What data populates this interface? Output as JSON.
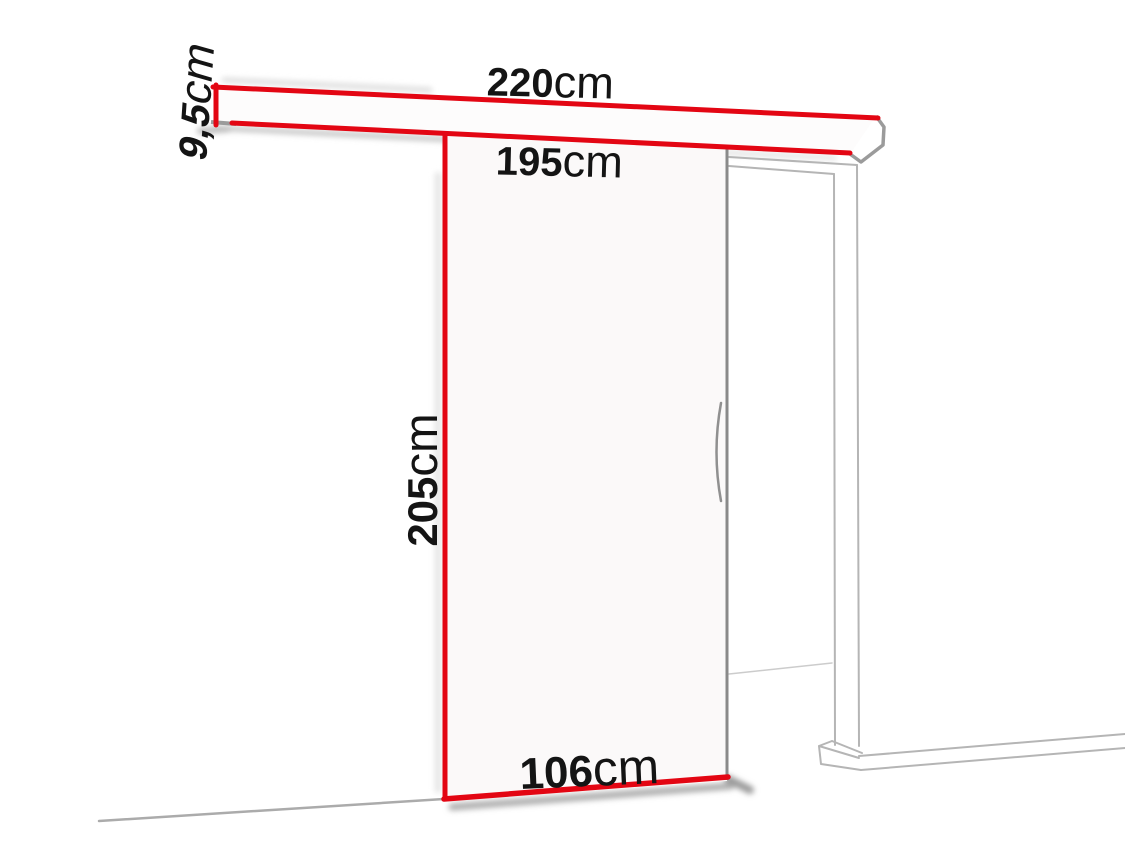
{
  "diagram": {
    "labels": {
      "rail_height": {
        "value": "9,5",
        "unit": "cm"
      },
      "rail_length": {
        "value": "220",
        "unit": "cm"
      },
      "passage_width": {
        "value": "195",
        "unit": "cm"
      },
      "door_height": {
        "value": "205",
        "unit": "cm"
      },
      "door_width": {
        "value": "106",
        "unit": "cm"
      }
    },
    "colors": {
      "dimension_red": "#e30613",
      "label_text": "#141414",
      "frame_line_gray": "#b5b5b5",
      "door_edge_gray": "#8a8a8a",
      "end_cap_gray": "#9b9b9b",
      "floor_line_gray": "#ababab",
      "background": "#ffffff"
    }
  }
}
